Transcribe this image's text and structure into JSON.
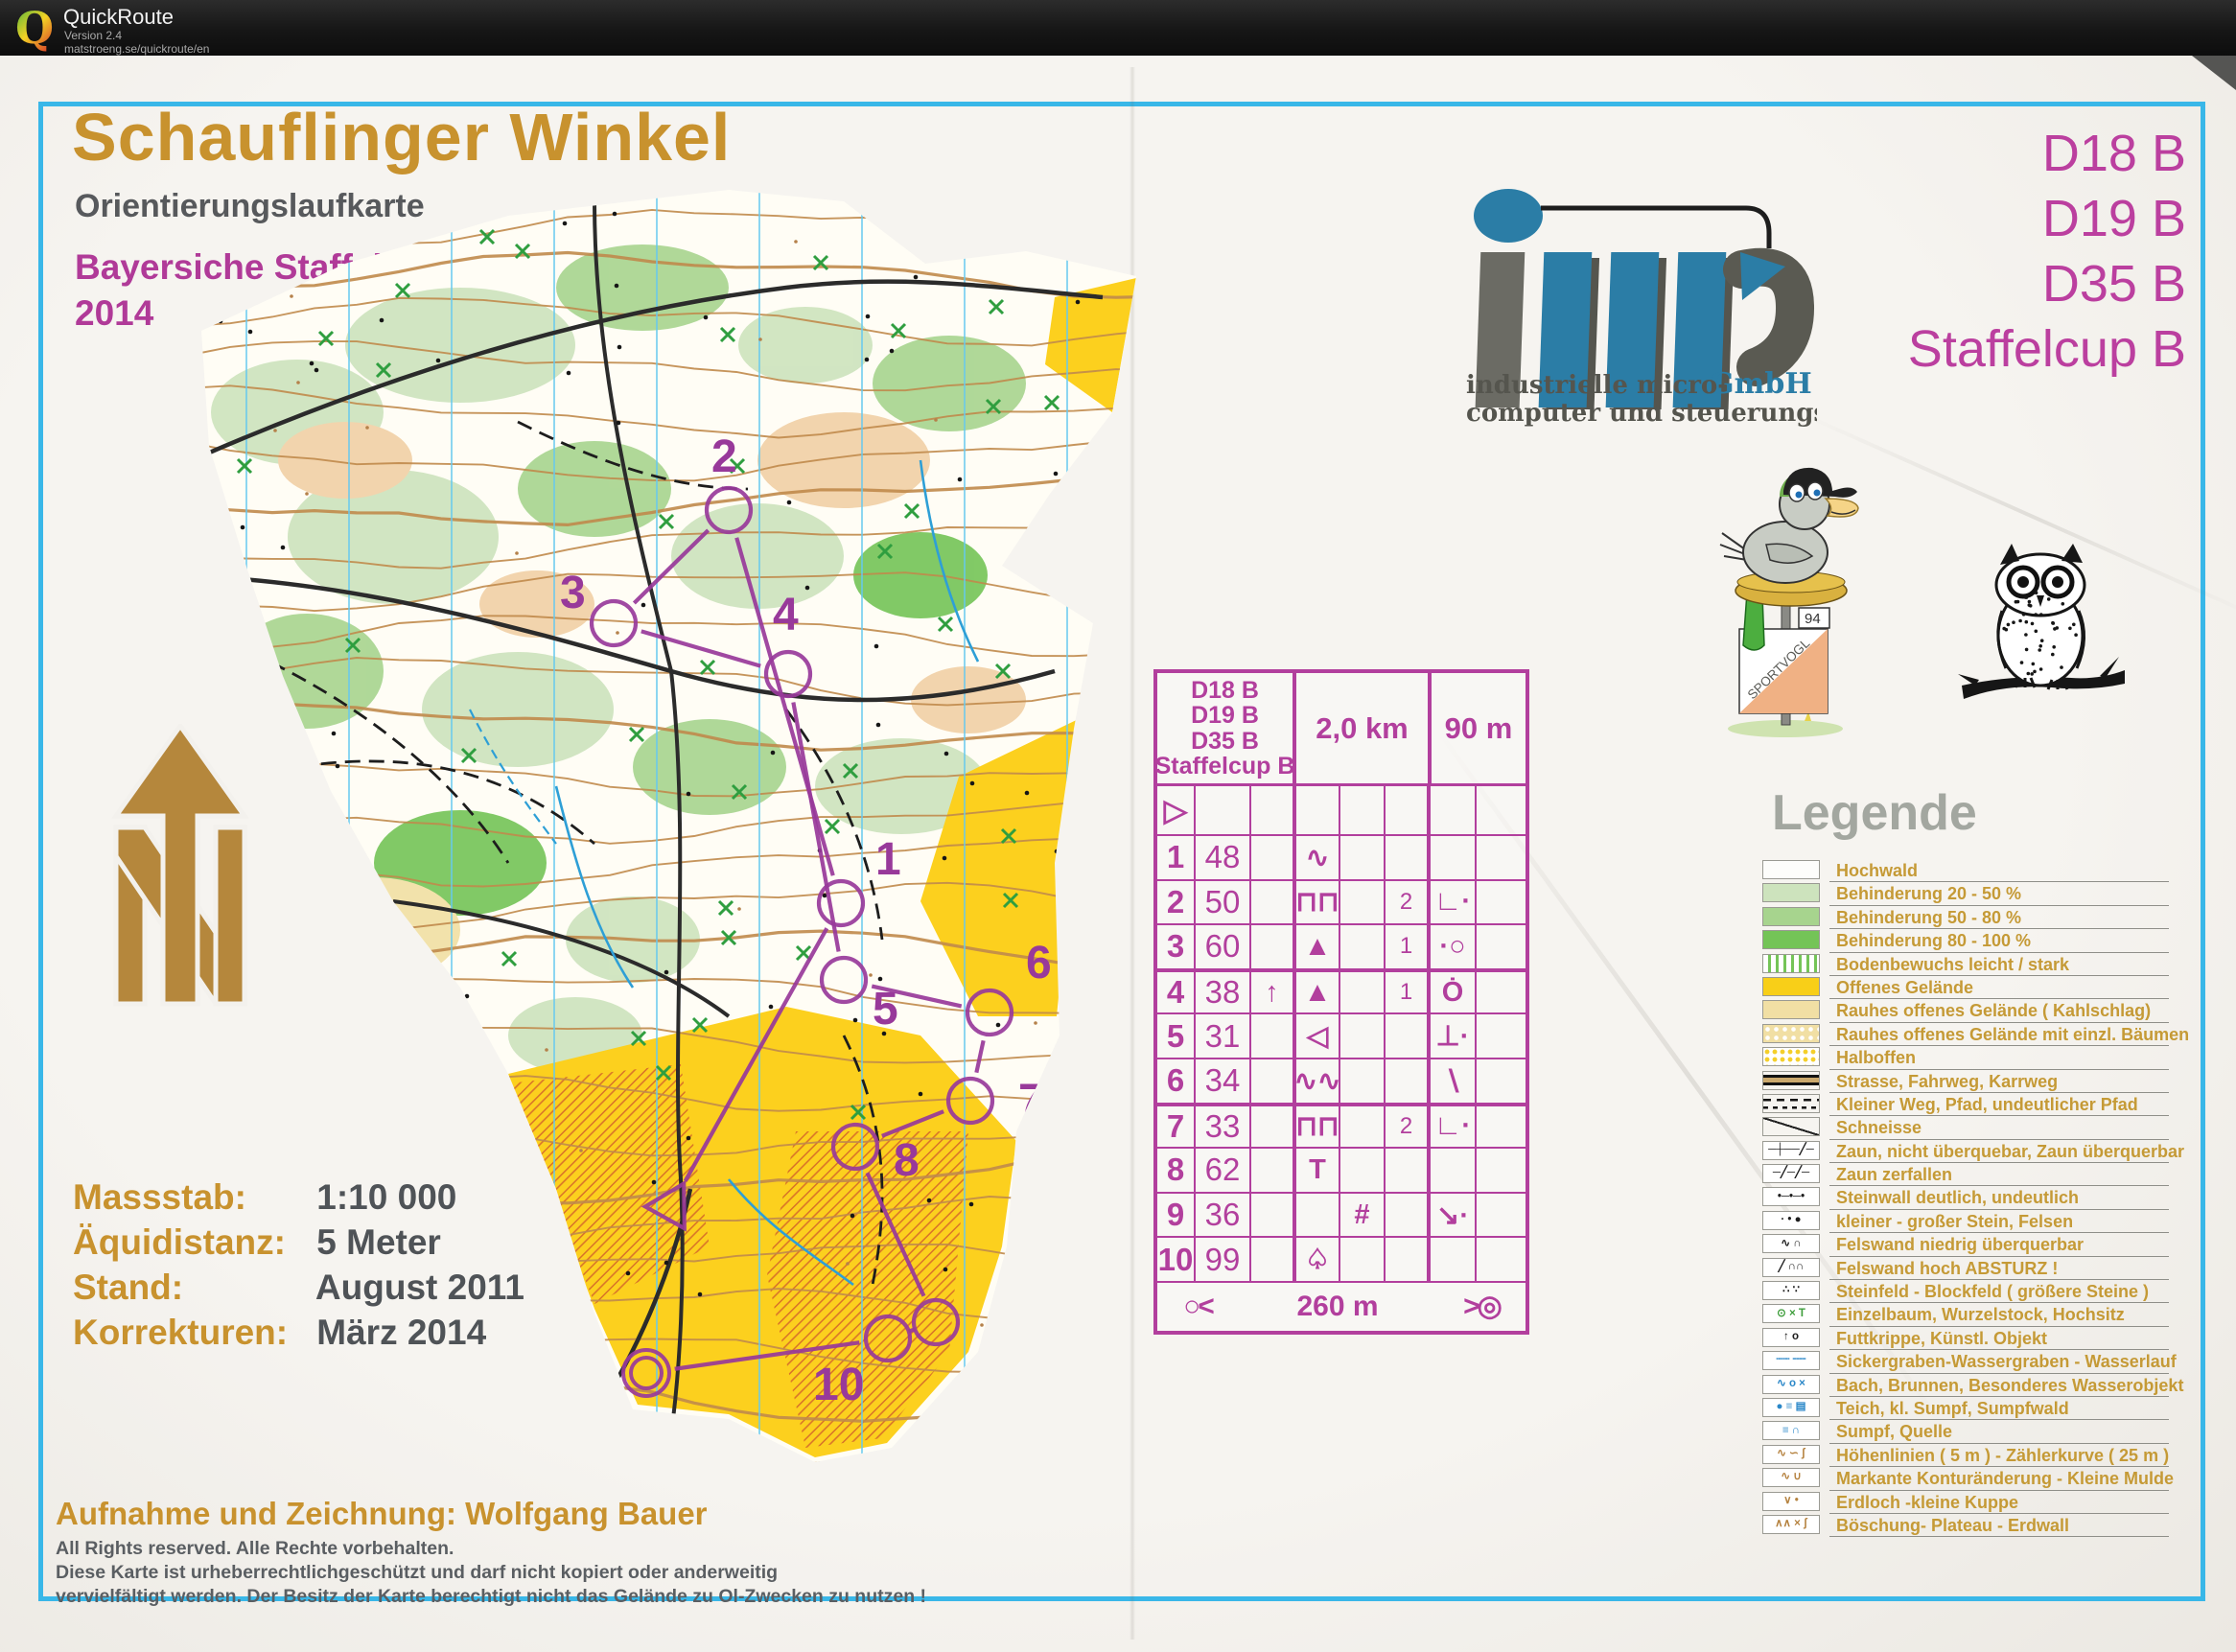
{
  "app": {
    "name": "QuickRoute",
    "version": "Version 2.4",
    "url": "matstroeng.se/quickroute/en",
    "logo_letter": "Q"
  },
  "map_header": {
    "title": "Schauflinger Winkel",
    "subtitle": "Orientierungslaufkarte",
    "event_line1": "Bayersiche Staffelmeisterschaft",
    "event_line2": "2014"
  },
  "classes": [
    "D18 B",
    "D19 B",
    "D35 B",
    "Staffelcup B"
  ],
  "ims_logo": {
    "company_suffix": "GmbH",
    "line1": "industrielle micro-",
    "line2": "computer und steuerungstechnik"
  },
  "mascots": {
    "flag_text": "SPORTVOGL",
    "flag_number": "94"
  },
  "course_info": {
    "distance": "2,0 km",
    "climb": "90 m",
    "start_symbol": "▷",
    "finish_left": "○<",
    "finish_distance": "260 m",
    "finish_right": ">◎",
    "controls": [
      {
        "no": "1",
        "code": "48",
        "c": "",
        "d": "∿",
        "e": "",
        "f": "",
        "g": "",
        "h": ""
      },
      {
        "no": "2",
        "code": "50",
        "c": "",
        "d": "⊓⊓",
        "e": "",
        "f": "2",
        "g": "∟·",
        "h": ""
      },
      {
        "no": "3",
        "code": "60",
        "c": "",
        "d": "▲",
        "e": "",
        "f": "1",
        "g": "·○",
        "h": ""
      },
      {
        "no": "4",
        "code": "38",
        "c": "↑",
        "d": "▲",
        "e": "",
        "f": "1",
        "g": "Ȯ",
        "h": ""
      },
      {
        "no": "5",
        "code": "31",
        "c": "",
        "d": "◁",
        "e": "",
        "f": "",
        "g": "⊥·",
        "h": ""
      },
      {
        "no": "6",
        "code": "34",
        "c": "",
        "d": "∿∿",
        "e": "",
        "f": "",
        "g": "∖",
        "h": ""
      },
      {
        "no": "7",
        "code": "33",
        "c": "",
        "d": "⊓⊓",
        "e": "",
        "f": "2",
        "g": "∟·",
        "h": ""
      },
      {
        "no": "8",
        "code": "62",
        "c": "",
        "d": "T",
        "e": "",
        "f": "",
        "g": "",
        "h": ""
      },
      {
        "no": "9",
        "code": "36",
        "c": "",
        "d": "",
        "e": "#",
        "f": "",
        "g": "↘·",
        "h": ""
      },
      {
        "no": "10",
        "code": "99",
        "c": "",
        "d": "♤",
        "e": "",
        "f": "",
        "g": "",
        "h": ""
      }
    ]
  },
  "map_info": {
    "rows": [
      {
        "label": "Massstab:",
        "value": "1:10 000"
      },
      {
        "label": "Äquidistanz:",
        "value": "5 Meter"
      },
      {
        "label": "Stand:",
        "value": "August 2011"
      },
      {
        "label": "Korrekturen:",
        "value": "März 2014"
      }
    ]
  },
  "credits": {
    "author_line": "Aufnahme und Zeichnung: Wolfgang Bauer",
    "copyright_lines": [
      "All Rights reserved.  Alle Rechte vorbehalten.",
      "Diese Karte  ist urheberrechtlichgeschützt  und darf nicht kopiert oder  anderweitig",
      "vervielfältigt werden.  Der Besitz der Karte berechtigt nicht das Gelände zu Ol-Zwecken zu nutzen !"
    ]
  },
  "legend": {
    "heading": "Legende",
    "items": [
      {
        "label": "Hochwald",
        "swatch": "white"
      },
      {
        "label": "Behinderung 20 - 50 %",
        "swatch": "green1"
      },
      {
        "label": "Behinderung 50 - 80 %",
        "swatch": "green2"
      },
      {
        "label": "Behinderung 80 - 100 %",
        "swatch": "green3"
      },
      {
        "label": "Bodenbewuchs leicht / stark",
        "swatch": "greenstripes"
      },
      {
        "label": "Offenes Gelände",
        "swatch": "yellow"
      },
      {
        "label": "Rauhes offenes Gelände ( Kahlschlag)",
        "swatch": "paleyellow"
      },
      {
        "label": "Rauhes offenes Gelände mit einzl. Bäumen",
        "swatch": "paleyellow-dots"
      },
      {
        "label": "Halboffen",
        "swatch": "yellow-dots"
      },
      {
        "label": "Strasse, Fahrweg, Karrweg",
        "swatch": "road"
      },
      {
        "label": "Kleiner Weg, Pfad, undeutlicher Pfad",
        "swatch": "paths"
      },
      {
        "label": "Schneisse",
        "swatch": "schneisse"
      },
      {
        "label": "Zaun, nicht überquebar, Zaun überquerbar",
        "swatch": "glyph",
        "glyph": "─┼──╱─",
        "color": "black"
      },
      {
        "label": "Zaun zerfallen",
        "swatch": "glyph",
        "glyph": "─╱─╱─",
        "color": "black"
      },
      {
        "label": "Steinwall deutlich, undeutlich",
        "swatch": "glyph",
        "glyph": "•─•─•",
        "color": "black"
      },
      {
        "label": "kleiner - großer  Stein, Felsen",
        "swatch": "glyph",
        "glyph": "·  •  ●",
        "color": "black"
      },
      {
        "label": "Felswand niedrig überquerbar",
        "swatch": "glyph",
        "glyph": "∿ ∩",
        "color": "black"
      },
      {
        "label": "Felswand hoch ABSTURZ !",
        "swatch": "glyph",
        "glyph": "╱ ∩∩",
        "color": "black"
      },
      {
        "label": "Steinfeld - Blockfeld ( größere Steine )",
        "swatch": "glyph",
        "glyph": "∴ ∵",
        "color": "black"
      },
      {
        "label": "Einzelbaum, Wurzelstock, Hochsitz",
        "swatch": "glyph",
        "glyph": "⊙ × T",
        "color": "green"
      },
      {
        "label": "Futtkrippe, Künstl. Objekt",
        "swatch": "glyph",
        "glyph": "↑  o",
        "color": "black"
      },
      {
        "label": "Sickergraben-Wassergraben - Wasserlauf",
        "swatch": "glyph",
        "glyph": "┄┄ ╌╌",
        "color": "blue"
      },
      {
        "label": "Bach, Brunnen, Besonderes Wasserobjekt",
        "swatch": "glyph",
        "glyph": "∿ o ×",
        "color": "blue"
      },
      {
        "label": "Teich, kl. Sumpf, Sumpfwald",
        "swatch": "glyph",
        "glyph": "● ≡ ▤",
        "color": "blue"
      },
      {
        "label": "Sumpf, Quelle",
        "swatch": "glyph",
        "glyph": "≡ ∩",
        "color": "blue"
      },
      {
        "label": "Höhenlinien ( 5 m ) - Zählerkurve ( 25 m )",
        "swatch": "glyph",
        "glyph": "∿ ∽ ʃ",
        "color": "brown"
      },
      {
        "label": "Markante Konturänderung - Kleine Mulde",
        "swatch": "glyph",
        "glyph": "∿ ∪",
        "color": "brown"
      },
      {
        "label": "Erdloch -kleine Kuppe",
        "swatch": "glyph",
        "glyph": "∨  •",
        "color": "brown"
      },
      {
        "label": "Böschung- Plateau - Erdwall",
        "swatch": "glyph",
        "glyph": "∧∧ × ʃ",
        "color": "brown"
      }
    ]
  }
}
